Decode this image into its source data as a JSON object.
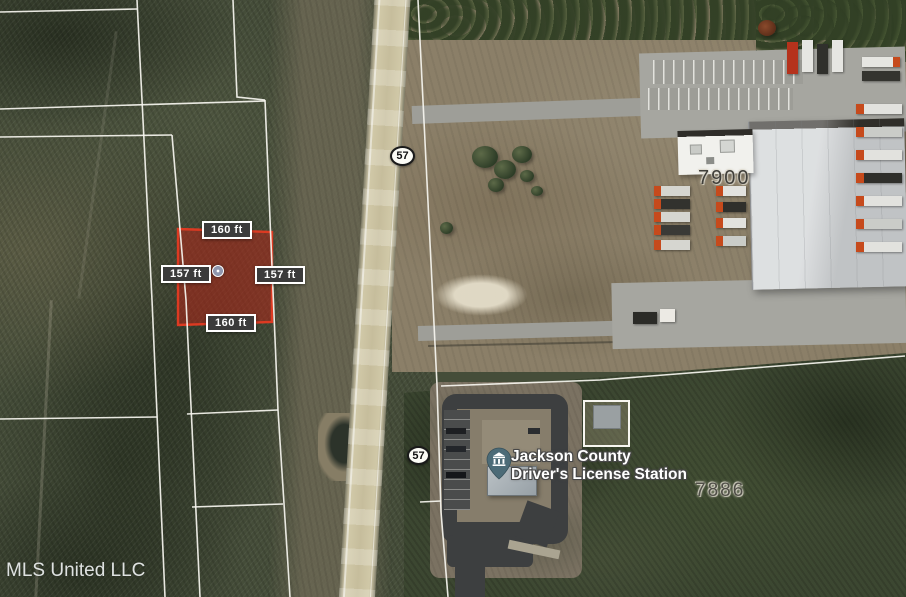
{
  "map": {
    "type": "satellite-parcel-map",
    "watermark": "MLS United LLC",
    "highlighted_parcel": {
      "dimensions": {
        "top": "160 ft",
        "bottom": "160 ft",
        "left": "157 ft",
        "right": "157 ft"
      },
      "fill_color": "#b3271a",
      "outline_color": "#dd3a22",
      "marker_icon": "parcel-center-marker"
    },
    "highway_shields": [
      {
        "route": "57"
      },
      {
        "route": "57"
      }
    ],
    "address_labels": [
      {
        "number": "7900"
      },
      {
        "number": "7886"
      }
    ],
    "poi_label": {
      "line1": "Jackson County",
      "line2": "Driver's License Station",
      "icon": "government-building-pin-icon",
      "pin_color": "#4c6b77"
    },
    "boundary_line_color": "#f7f6f0"
  }
}
